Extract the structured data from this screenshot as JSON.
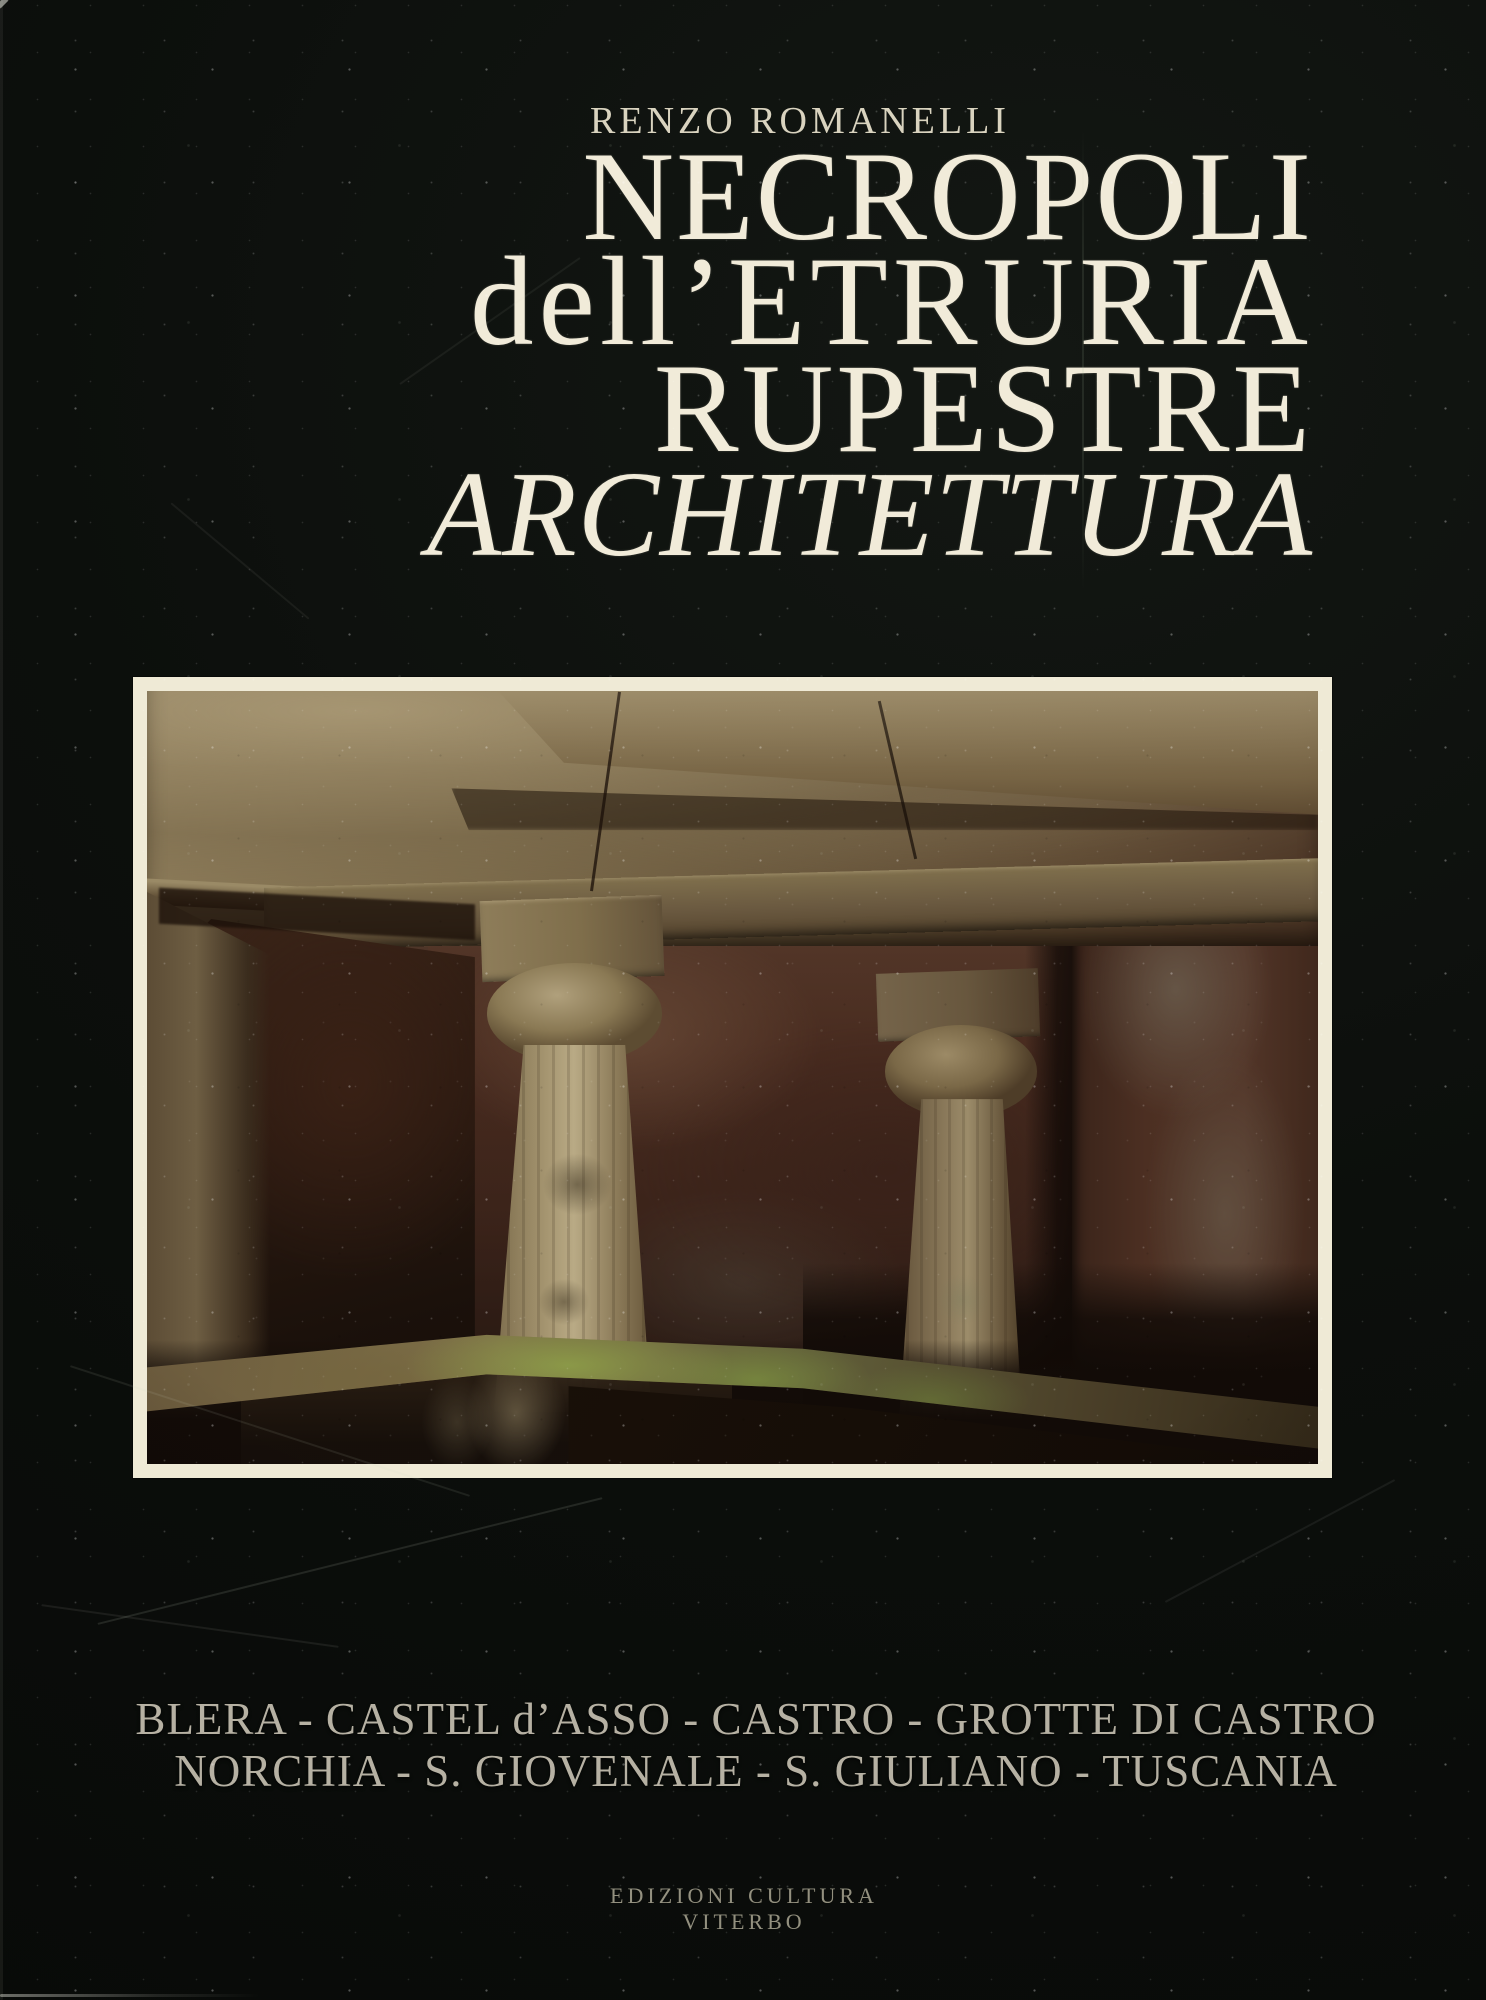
{
  "cover": {
    "author": "RENZO ROMANELLI",
    "title_line1": "NECROPOLI",
    "title_line2": "dell’ETRURIA",
    "title_line3": "RUPESTRE",
    "title_line4": "ARCHITETTURA",
    "sites_line1": "BLERA - CASTEL d’ASSO - CASTRO - GROTTE DI CASTRO",
    "sites_line2": "NORCHIA - S. GIOVENALE - S. GIULIANO - TUSCANIA",
    "publisher_line1": "EDIZIONI CULTURA",
    "publisher_line2": "VITERBO",
    "photo_alt": "Interior of an Etruscan rock-cut tomb with two tufa columns, carved ceiling beams, a dark doorway niche and a mossy water basin",
    "colors": {
      "cover_background": "#0c0f0c",
      "title_text": "#f1ebd9",
      "author_text": "#d9d3bf",
      "sites_text": "#b6b1a3",
      "publisher_text": "#93907f",
      "photo_frame": "#efead6"
    }
  }
}
